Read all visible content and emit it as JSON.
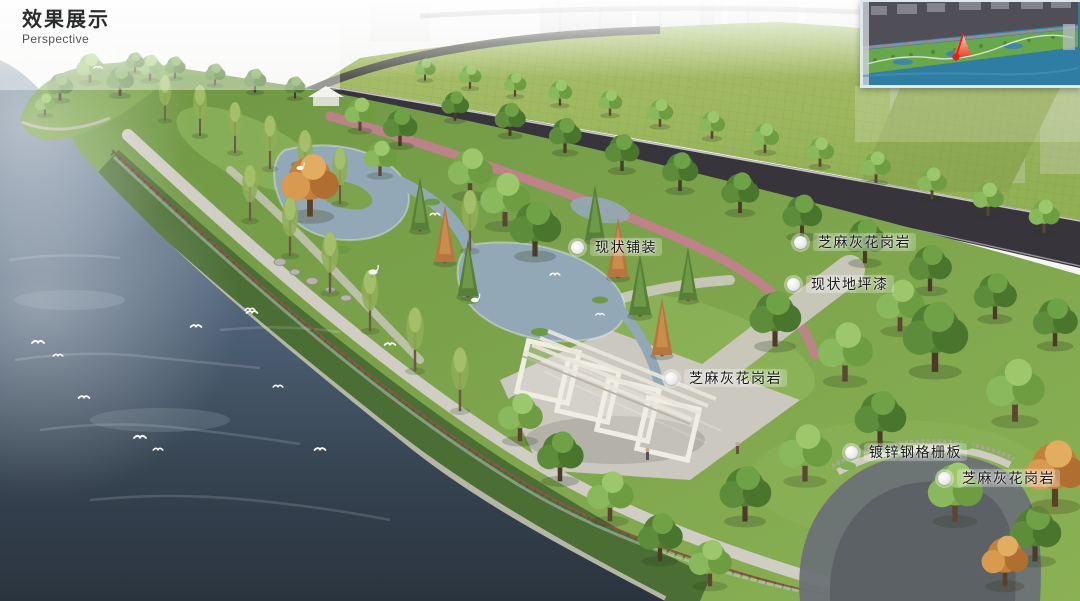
{
  "header": {
    "title": "效果展示",
    "subtitle": "Perspective"
  },
  "callouts": [
    {
      "id": "existing-paving",
      "text": "现状铺装"
    },
    {
      "id": "sesame-gray-granite-road",
      "text": "芝麻灰花岗岩"
    },
    {
      "id": "existing-floor-paint",
      "text": "现状地坪漆"
    },
    {
      "id": "sesame-gray-granite-plaza",
      "text": "芝麻灰花岗岩"
    },
    {
      "id": "galvanized-steel-grating",
      "text": "镀锌钢格栅板"
    },
    {
      "id": "sesame-gray-granite-wall",
      "text": "芝麻灰花岗岩"
    }
  ],
  "inset_map": {
    "description": "site-plan-thumbnail-with-viewpoint-arrow",
    "marker": "viewpoint-arrow"
  },
  "palette": {
    "label-text": "#1b1b1b",
    "road": "#37343b",
    "track": "#c48090",
    "pond": "#93a8b6",
    "path": "#d0cdc4",
    "plaza": "#cbc8bf",
    "slope": "#4a6e33",
    "inset-water": "#2f7da2",
    "inset-green": "#69a84a",
    "inset-urban": "#504f57",
    "inset-marker": "#e02315"
  }
}
